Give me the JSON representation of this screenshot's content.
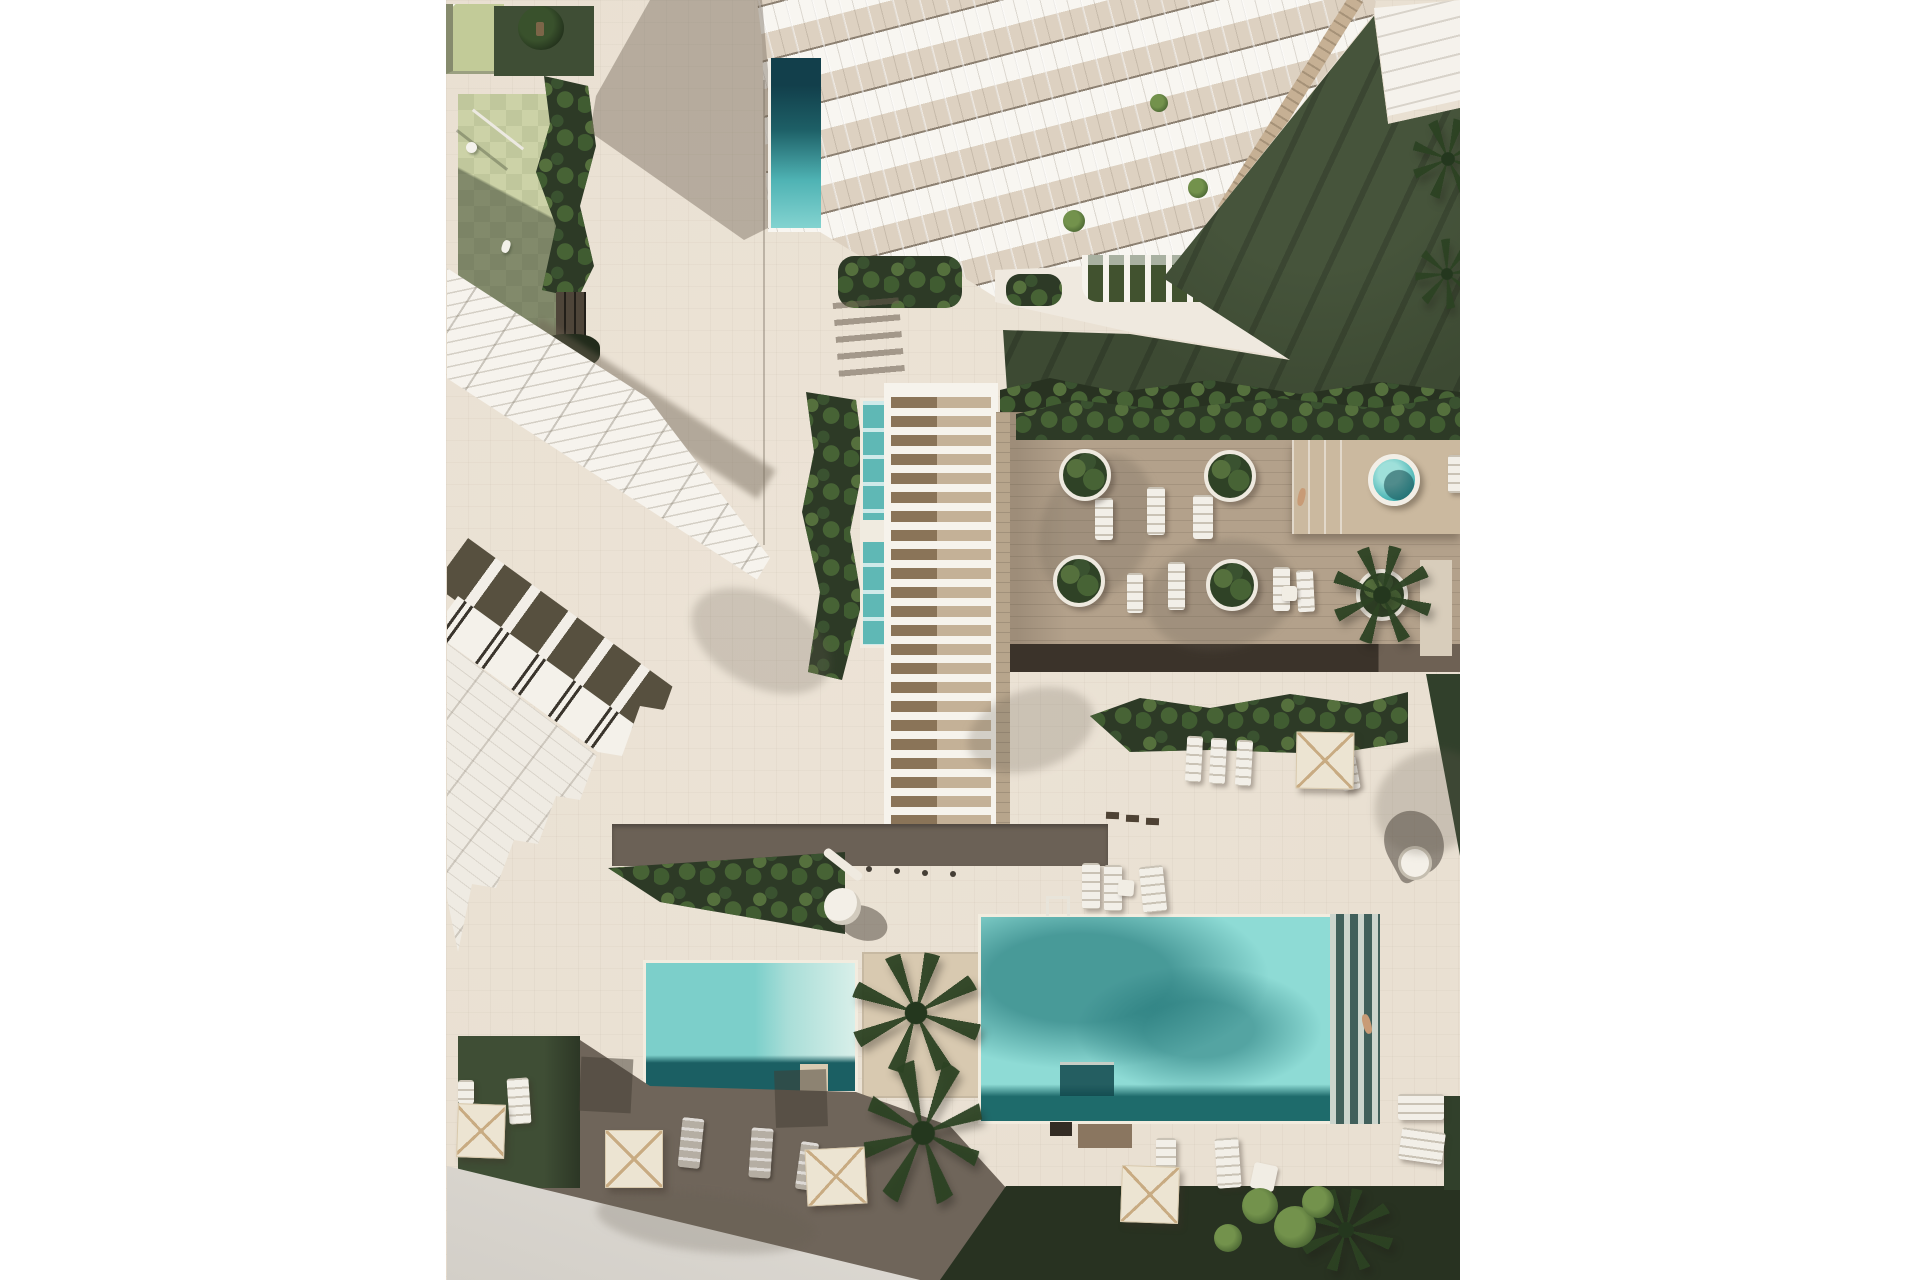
{
  "scene": {
    "description": "Aerial top-down architectural rendering of a white residential complex: terraced tower at top right with private lap pool, diagonal row of townhouses at left, central white pergola with water channel, wooden deck with round planters and sun loungers, two turquoise swimming pools, round spas, cream parasols, dark lawns, tropical planting and a light promenade road at the bottom left.",
    "style": "photorealistic render, no text"
  },
  "palette": {
    "pavement": "#e9e0d2",
    "pavementShadow": "#6f655a",
    "deck": "#b3a18b",
    "deckEdge": "#3b332a",
    "lawn": "#3d4a33",
    "hedge": "#2d3a26",
    "hedgeLight": "#55703d",
    "poolLight": "#8edbd5",
    "poolMid": "#5fc0bd",
    "poolDark": "#1e6b6b",
    "white": "#f6f3ec",
    "glass": "#ddd1c1",
    "balconyDark": "#57503f",
    "spine": "#c6b094",
    "parasol": "#ece4d2",
    "parasolRib": "#c8ab82",
    "road": "#e0dcd6",
    "wood": "#8a7458",
    "woodLight": "#c4b197",
    "planterBeige": "#d8c9b0",
    "skin": "#c89b76",
    "playTileA": "#ccd2a7",
    "playTileB": "#c0c79c",
    "oliveRoof": "#c2cb98",
    "grass": "#3f4e35",
    "vegDark": "#283221"
  },
  "objects": {
    "soft_shadows": [
      {
        "x": 240,
        "y": 596,
        "w": 150,
        "h": 90,
        "r": 28
      },
      {
        "x": 520,
        "y": 690,
        "w": 130,
        "h": 80,
        "r": -18
      },
      {
        "x": 926,
        "y": 752,
        "w": 116,
        "h": 100,
        "r": -35
      },
      {
        "x": 596,
        "y": 452,
        "w": 110,
        "h": 150,
        "r": 22
      },
      {
        "x": 700,
        "y": 540,
        "w": 150,
        "h": 110,
        "r": -12
      },
      {
        "x": 150,
        "y": 1192,
        "w": 220,
        "h": 60,
        "r": 6
      }
    ],
    "parasol_shadows": [
      {
        "x": 134,
        "y": 1058,
        "w": 52,
        "h": 54,
        "r": 3
      },
      {
        "x": 329,
        "y": 1070,
        "w": 52,
        "h": 57,
        "r": -2
      }
    ],
    "loungers_grey": [
      {
        "x": 234,
        "y": 1118,
        "w": 22,
        "h": 50,
        "r": 6
      },
      {
        "x": 304,
        "y": 1128,
        "w": 22,
        "h": 50,
        "r": 4
      },
      {
        "x": 352,
        "y": 1142,
        "w": 18,
        "h": 48,
        "r": 8
      }
    ],
    "loungers_white": [
      {
        "x": 649,
        "y": 498,
        "w": 18,
        "h": 42,
        "r": 0
      },
      {
        "x": 701,
        "y": 487,
        "w": 18,
        "h": 48,
        "r": 0
      },
      {
        "x": 747,
        "y": 495,
        "w": 20,
        "h": 44,
        "r": 0
      },
      {
        "x": 681,
        "y": 573,
        "w": 16,
        "h": 40,
        "r": 0
      },
      {
        "x": 722,
        "y": 562,
        "w": 17,
        "h": 48,
        "r": 0
      },
      {
        "x": 827,
        "y": 567,
        "w": 17,
        "h": 44,
        "r": 0
      },
      {
        "x": 851,
        "y": 570,
        "w": 17,
        "h": 42,
        "r": -3
      },
      {
        "x": 740,
        "y": 736,
        "w": 16,
        "h": 46,
        "r": 3
      },
      {
        "x": 764,
        "y": 738,
        "w": 16,
        "h": 46,
        "r": 3
      },
      {
        "x": 790,
        "y": 740,
        "w": 16,
        "h": 46,
        "r": 3
      },
      {
        "x": 894,
        "y": 756,
        "w": 18,
        "h": 34,
        "r": -10
      },
      {
        "x": 62,
        "y": 1078,
        "w": 22,
        "h": 46,
        "r": -4
      },
      {
        "x": 12,
        "y": 1080,
        "w": 16,
        "h": 24,
        "r": 0
      },
      {
        "x": 710,
        "y": 1138,
        "w": 20,
        "h": 30,
        "r": 0
      },
      {
        "x": 770,
        "y": 1138,
        "w": 24,
        "h": 50,
        "r": -4
      },
      {
        "x": 952,
        "y": 1094,
        "w": 46,
        "h": 26,
        "r": 0
      },
      {
        "x": 954,
        "y": 1130,
        "w": 44,
        "h": 32,
        "r": 8
      },
      {
        "x": 1002,
        "y": 455,
        "w": 16,
        "h": 38,
        "r": 0
      },
      {
        "x": 636,
        "y": 863,
        "w": 18,
        "h": 46,
        "r": 0
      },
      {
        "x": 658,
        "y": 865,
        "w": 18,
        "h": 46,
        "r": 0
      },
      {
        "x": 695,
        "y": 866,
        "w": 24,
        "h": 46,
        "r": -6
      }
    ],
    "tables": [
      {
        "x": 836,
        "y": 586,
        "w": 15,
        "h": 15,
        "r": 0
      },
      {
        "x": 806,
        "y": 1164,
        "w": 24,
        "h": 26,
        "r": 12
      },
      {
        "x": 672,
        "y": 880,
        "w": 16,
        "h": 16,
        "r": 4
      }
    ],
    "planters": [
      {
        "x": 613,
        "y": 449
      },
      {
        "x": 758,
        "y": 450
      },
      {
        "x": 607,
        "y": 555
      },
      {
        "x": 760,
        "y": 559
      },
      {
        "x": 910,
        "y": 569
      }
    ],
    "palms": [
      {
        "x": 886,
        "y": 545,
        "w": 100,
        "h": 100,
        "r": 0
      },
      {
        "x": 966,
        "y": 118,
        "w": 72,
        "h": 82,
        "r": 0
      },
      {
        "x": 970,
        "y": 238,
        "w": 62,
        "h": 72,
        "r": 20
      },
      {
        "x": 404,
        "y": 952,
        "w": 132,
        "h": 122,
        "r": 0
      },
      {
        "x": 418,
        "y": 1058,
        "w": 118,
        "h": 150,
        "r": 8
      },
      {
        "x": 852,
        "y": 1188,
        "w": 96,
        "h": 84,
        "r": 0
      }
    ],
    "leaf_clusters": [
      {
        "x": 796,
        "y": 1188,
        "d": 36
      },
      {
        "x": 828,
        "y": 1206,
        "d": 42
      },
      {
        "x": 856,
        "y": 1186,
        "d": 32
      },
      {
        "x": 768,
        "y": 1224,
        "d": 28
      },
      {
        "x": 617,
        "y": 210,
        "d": 22
      },
      {
        "x": 742,
        "y": 178,
        "d": 20
      },
      {
        "x": 704,
        "y": 94,
        "d": 18
      }
    ],
    "persons": [
      {
        "x": 852,
        "y": 488,
        "w": 7,
        "h": 18,
        "r": 12
      },
      {
        "x": 917,
        "y": 1014,
        "w": 8,
        "h": 20,
        "r": -15
      }
    ],
    "lamps": [
      {
        "x": 420,
        "y": 866
      },
      {
        "x": 448,
        "y": 868
      },
      {
        "x": 476,
        "y": 870
      },
      {
        "x": 504,
        "y": 871
      }
    ],
    "dashes": [
      {
        "x": 660,
        "y": 812
      },
      {
        "x": 680,
        "y": 815
      },
      {
        "x": 700,
        "y": 818
      }
    ],
    "parasols": [
      {
        "x": 11,
        "y": 1104,
        "w": 48,
        "h": 54,
        "r": 2
      },
      {
        "x": 159,
        "y": 1130,
        "w": 58,
        "h": 58,
        "r": 0
      },
      {
        "x": 360,
        "y": 1148,
        "w": 60,
        "h": 57,
        "r": -3
      },
      {
        "x": 675,
        "y": 1166,
        "w": 58,
        "h": 57,
        "r": 2
      },
      {
        "x": 850,
        "y": 732,
        "w": 58,
        "h": 57,
        "r": 1
      }
    ]
  }
}
